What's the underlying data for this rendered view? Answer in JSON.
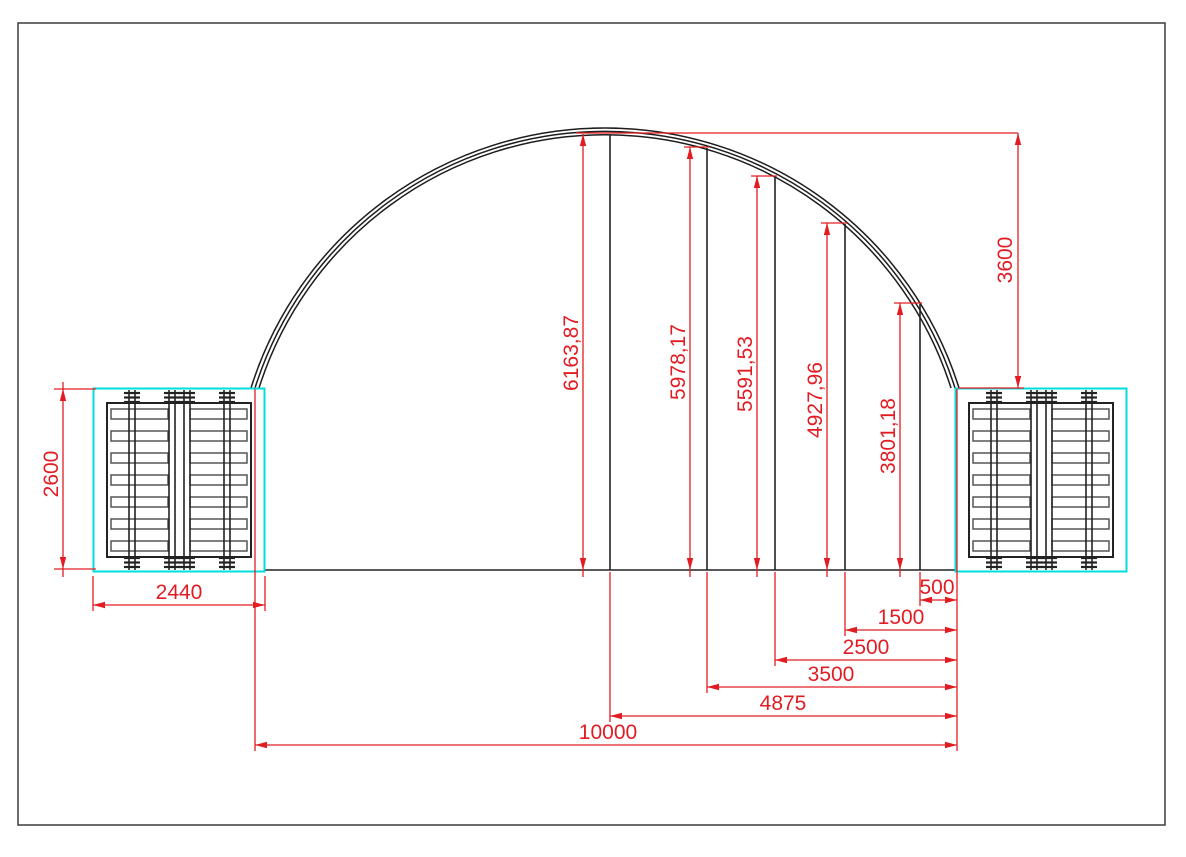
{
  "drawing": {
    "type": "container dome shelter cross-section",
    "colors": {
      "dimension_red": "#e11d23",
      "line_black": "#222222",
      "frame_cyan": "#00dede",
      "border_gray": "#3c3c3c"
    },
    "dimensions": {
      "container_height_mm": "2600",
      "container_width_mm": "2440",
      "arch_rise_mm": "3600",
      "arch_heights_mm": [
        "6163,87",
        "5978,17",
        "5591,53",
        "4927,96",
        "3801,18"
      ],
      "base_offsets_mm": [
        "500",
        "1500",
        "2500",
        "3500",
        "4875"
      ],
      "total_span_mm": "10000"
    }
  }
}
